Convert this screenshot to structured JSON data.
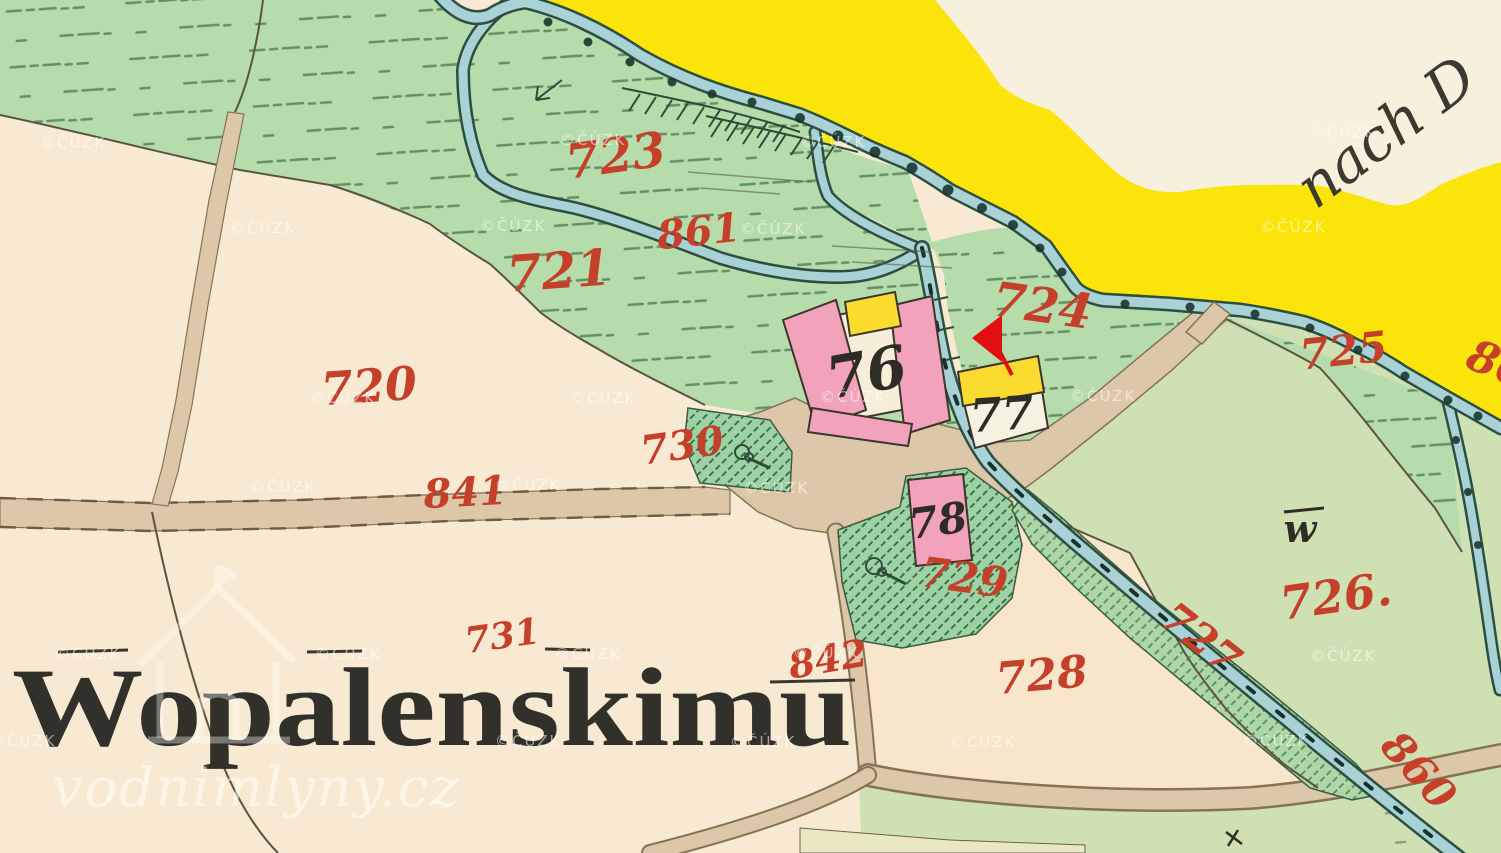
{
  "map": {
    "type": "historical-cadastral-map",
    "title_label": "Wopalenskimu",
    "direction_note": "nach D",
    "watermarks": {
      "cuzk": "©ČÚZK",
      "site": "vodnimlyny.cz"
    },
    "marker": {
      "type": "arrow-left",
      "color": "#e10f0f"
    },
    "parcel_labels": [
      {
        "text": "723"
      },
      {
        "text": "861"
      },
      {
        "text": "721"
      },
      {
        "text": "720"
      },
      {
        "text": "724"
      },
      {
        "text": "725"
      },
      {
        "text": "726."
      },
      {
        "text": "727"
      },
      {
        "text": "728"
      },
      {
        "text": "729"
      },
      {
        "text": "730"
      },
      {
        "text": "731"
      },
      {
        "text": "841"
      },
      {
        "text": "842"
      },
      {
        "text": "860"
      },
      {
        "text": "86"
      }
    ],
    "building_labels": [
      {
        "text": "76"
      },
      {
        "text": "77"
      },
      {
        "text": "78"
      }
    ],
    "symbols": {
      "meadow": "w"
    },
    "palette": {
      "paper": "#f8ead2",
      "paper_light": "#f6f0dd",
      "paper_pink": "#f8e6ca",
      "meadow": "#b7dcab",
      "meadow_light": "#cfe0b2",
      "garden": "#9ed2a4",
      "garden_hatch": "#2f6b44",
      "water": "#a9d2d6",
      "water_edge": "#2c4f41",
      "road": "#dcc7a8",
      "road_edge": "#857453",
      "highway_yellow": "#fbe40a",
      "building_pink": "#f2a3bb",
      "building_yellow": "#fbdc2e",
      "label_red": "#c5402a",
      "ink_black": "#2e2c24"
    }
  }
}
